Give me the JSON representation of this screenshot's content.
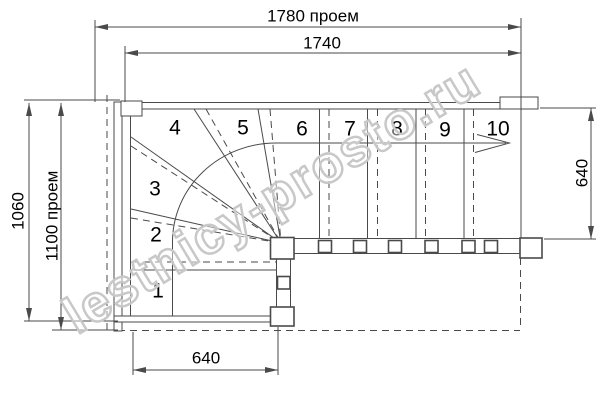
{
  "title": "Winder staircase plan drawing",
  "colors": {
    "line": "#4a4a4a",
    "text": "#000000",
    "watermark": "#c8c8c8",
    "background": "#ffffff"
  },
  "watermark": {
    "text": "lestnicy-prosto.ru"
  },
  "dimensions": {
    "top_outer": "1780 проем",
    "top_inner": "1740",
    "left_outer": "1060",
    "left_inner": "1100 проем",
    "right_side": "640",
    "bottom": "640"
  },
  "plan": {
    "step_labels": [
      "1",
      "2",
      "3",
      "4",
      "5",
      "6",
      "7",
      "8",
      "9",
      "10"
    ]
  }
}
